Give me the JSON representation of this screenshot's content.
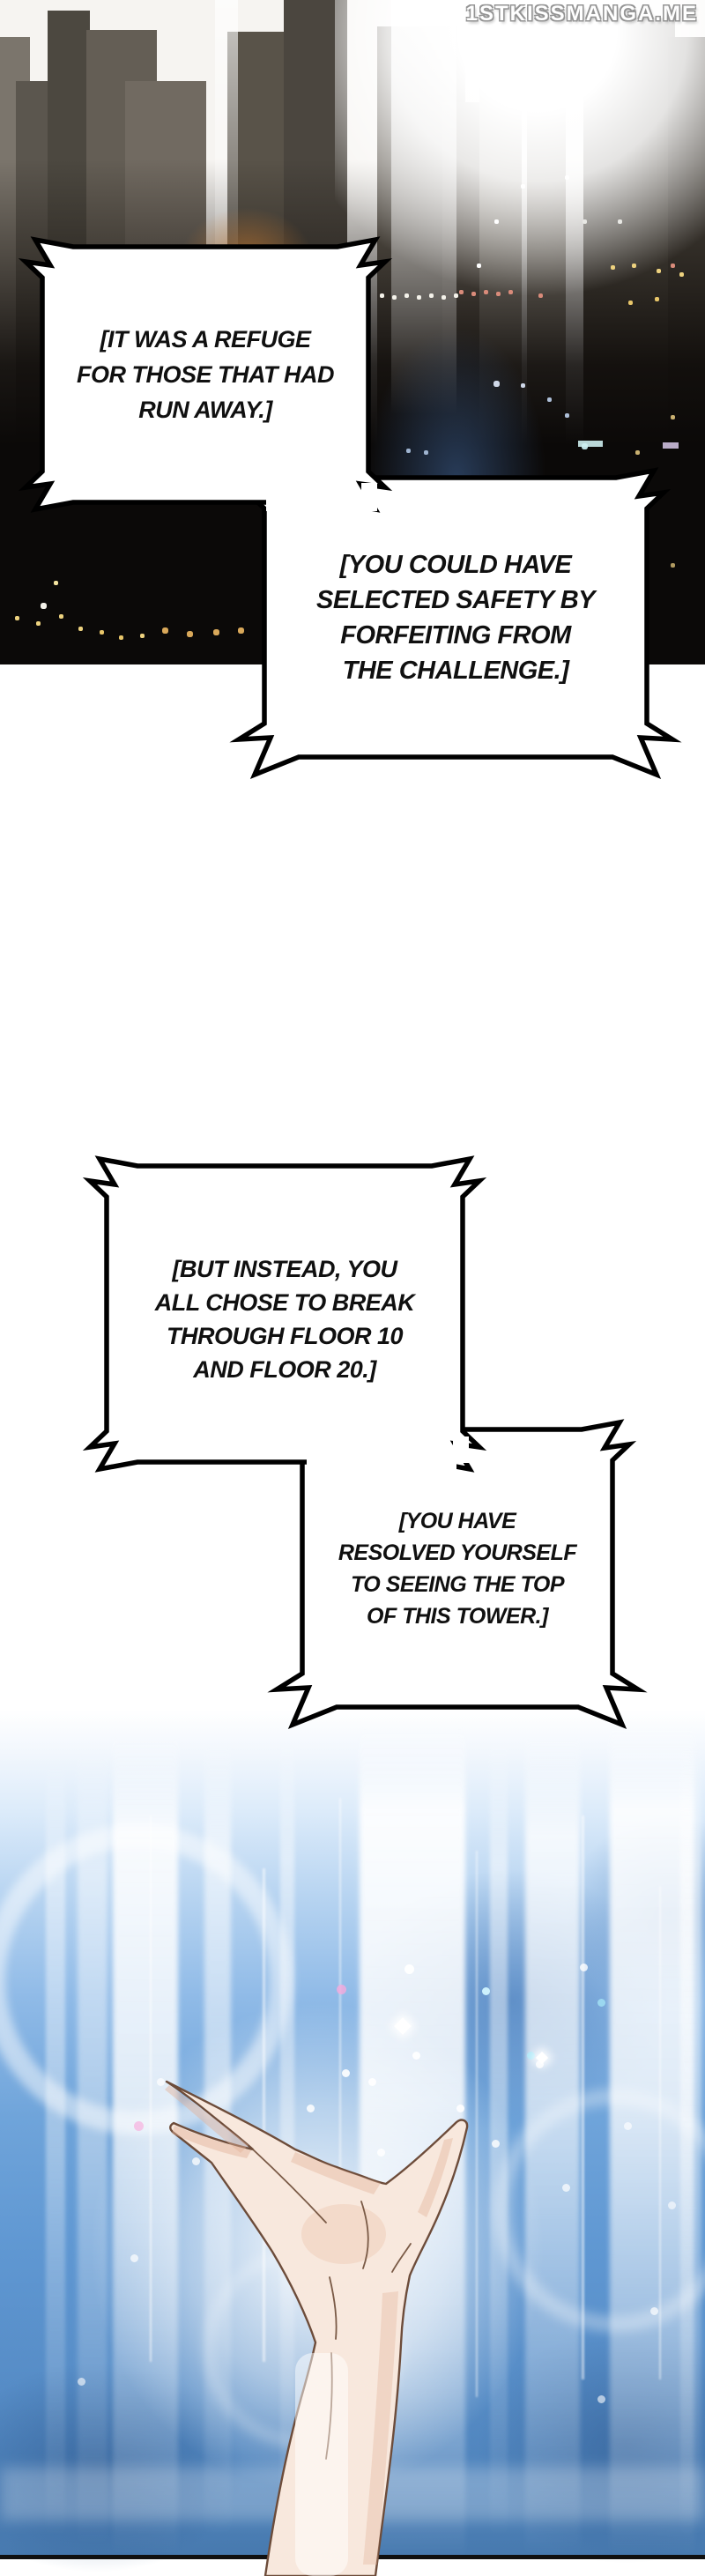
{
  "watermark": "1STKISSMANGA.ME",
  "panels": {
    "top": "night city skyline with blinding light",
    "bottom": "open hand reaching up into beams of light"
  },
  "bubbles": [
    {
      "lines": [
        "[IT WAS A REFUGE",
        "FOR THOSE THAT HAD",
        "RUN AWAY.]"
      ]
    },
    {
      "lines": [
        "[YOU COULD HAVE",
        "SELECTED SAFETY BY",
        "FORFEITING FROM",
        "THE CHALLENGE.]"
      ]
    },
    {
      "lines": [
        "[BUT INSTEAD, YOU",
        "ALL CHOSE TO BREAK",
        "THROUGH FLOOR 10",
        "AND FLOOR 20.]"
      ]
    },
    {
      "lines": [
        "[YOU HAVE",
        "RESOLVED YOURSELF",
        "TO SEEING THE TOP",
        "OF THIS TOWER.]"
      ]
    }
  ],
  "colors": {
    "bubble_fill": "#ffffff",
    "bubble_border": "#000000",
    "dialogue_text": "#101010",
    "watermark_text": "#ffffff",
    "night_sky": "#0b0908",
    "day_sky": "#5e96d2",
    "light_beam": "#ffffff",
    "skin": "#f8e8dd"
  }
}
